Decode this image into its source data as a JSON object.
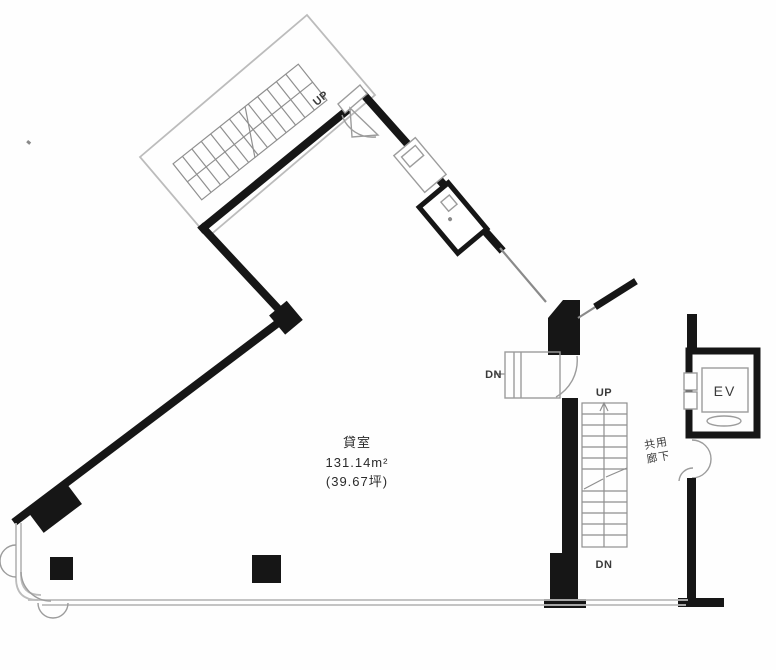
{
  "unit": {
    "name": "貸室",
    "area_m2": "131.14m²",
    "area_tsubo": "(39.67坪)"
  },
  "stairs": {
    "top_up_label": "UP",
    "right_up_label": "UP",
    "right_dn_label": "DN",
    "entry_dn_label": "DN"
  },
  "elevator": {
    "label": "EV"
  },
  "corridor": {
    "line1": "共用",
    "line2": "廊下"
  },
  "colors": {
    "wall": "#161616",
    "outline_light": "#bcbcbc",
    "outline_mid": "#9c9c9c",
    "tread": "#8f8f8f",
    "background": "#fefefe"
  }
}
